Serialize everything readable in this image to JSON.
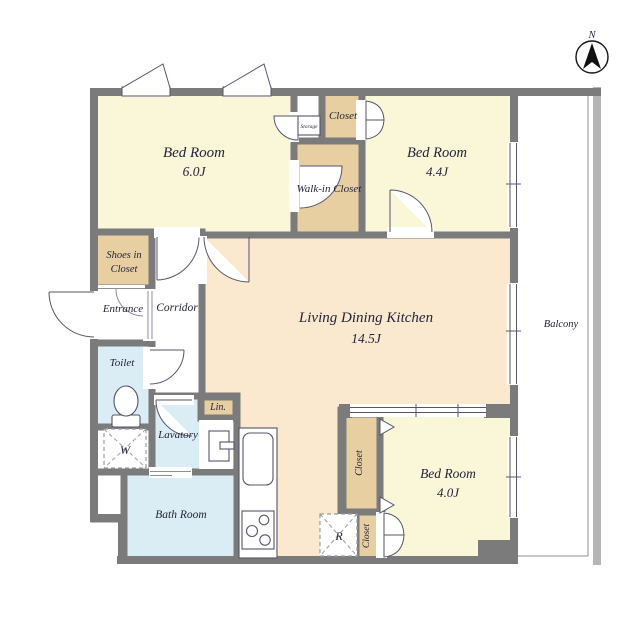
{
  "title": "Apartment floor plan",
  "colors": {
    "wall": "#7b7b7b",
    "outer_rail": "#b5b5b5",
    "bedroom": "#faf6d8",
    "closet": "#e7cfa1",
    "ldk": "#fbe9cf",
    "wet": "#daedf4",
    "white": "#ffffff",
    "text": "#23233c"
  },
  "compass": {
    "label": "N"
  },
  "rooms": {
    "bedroom_6": {
      "name": "Bed Room",
      "size": "6.0J"
    },
    "bedroom_44": {
      "name": "Bed Room",
      "size": "4.4J"
    },
    "bedroom_40": {
      "name": "Bed Room",
      "size": "4.0J"
    },
    "ldk": {
      "name": "Living Dining Kitchen",
      "size": "14.5J"
    },
    "balcony": {
      "name": "Balcony"
    },
    "walk_in_closet": {
      "name": "Walk-in Closet"
    },
    "closet_top": {
      "name": "Closet"
    },
    "storage": {
      "name": "Storage"
    },
    "shoes_closet": {
      "line1": "Shoes in",
      "line2": "Closet"
    },
    "entrance": {
      "name": "Entrance"
    },
    "corridor": {
      "name": "Corridor"
    },
    "toilet": {
      "name": "Toilet"
    },
    "lavatory": {
      "name": "Lavatory"
    },
    "linen": {
      "name": "Lin."
    },
    "bathroom": {
      "name": "Bath Room"
    },
    "closet_tall": {
      "name": "Closet"
    },
    "closet_small": {
      "name": "Closet"
    }
  },
  "appliances": {
    "washer": "W",
    "refrigerator": "R"
  }
}
